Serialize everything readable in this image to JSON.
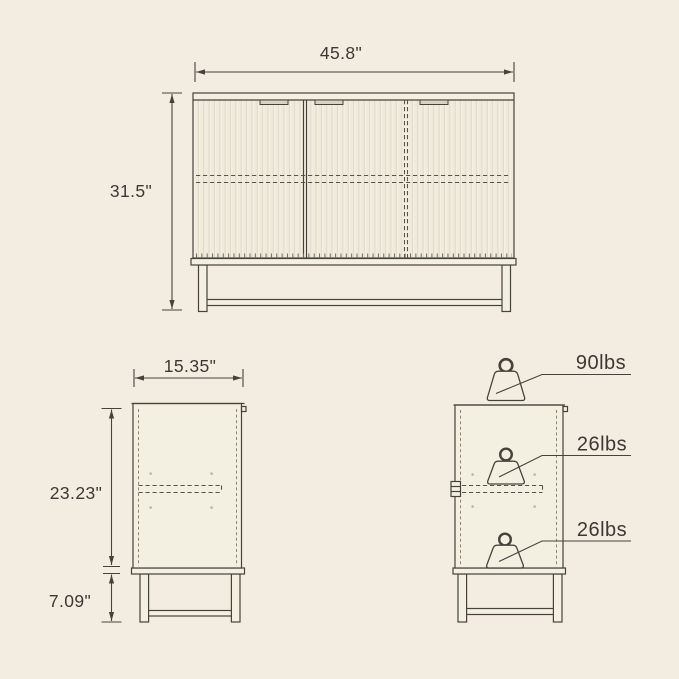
{
  "colors": {
    "background": "#f2ede0",
    "line": "#45433c",
    "text": "#3b3935",
    "flute_line": "#dcd7c5",
    "door_fill": "#f4f0e2"
  },
  "icons": {
    "capacity_icon": "weight-icon"
  },
  "front_view": {
    "width_label": "45.8\"",
    "height_label": "31.5\""
  },
  "side_view": {
    "width_label": "15.35\"",
    "body_height_label": "23.23\"",
    "leg_height_label": "7.09\""
  },
  "capacity_view": {
    "top_label": "90lbs",
    "middle_label": "26lbs",
    "bottom_label": "26lbs"
  }
}
